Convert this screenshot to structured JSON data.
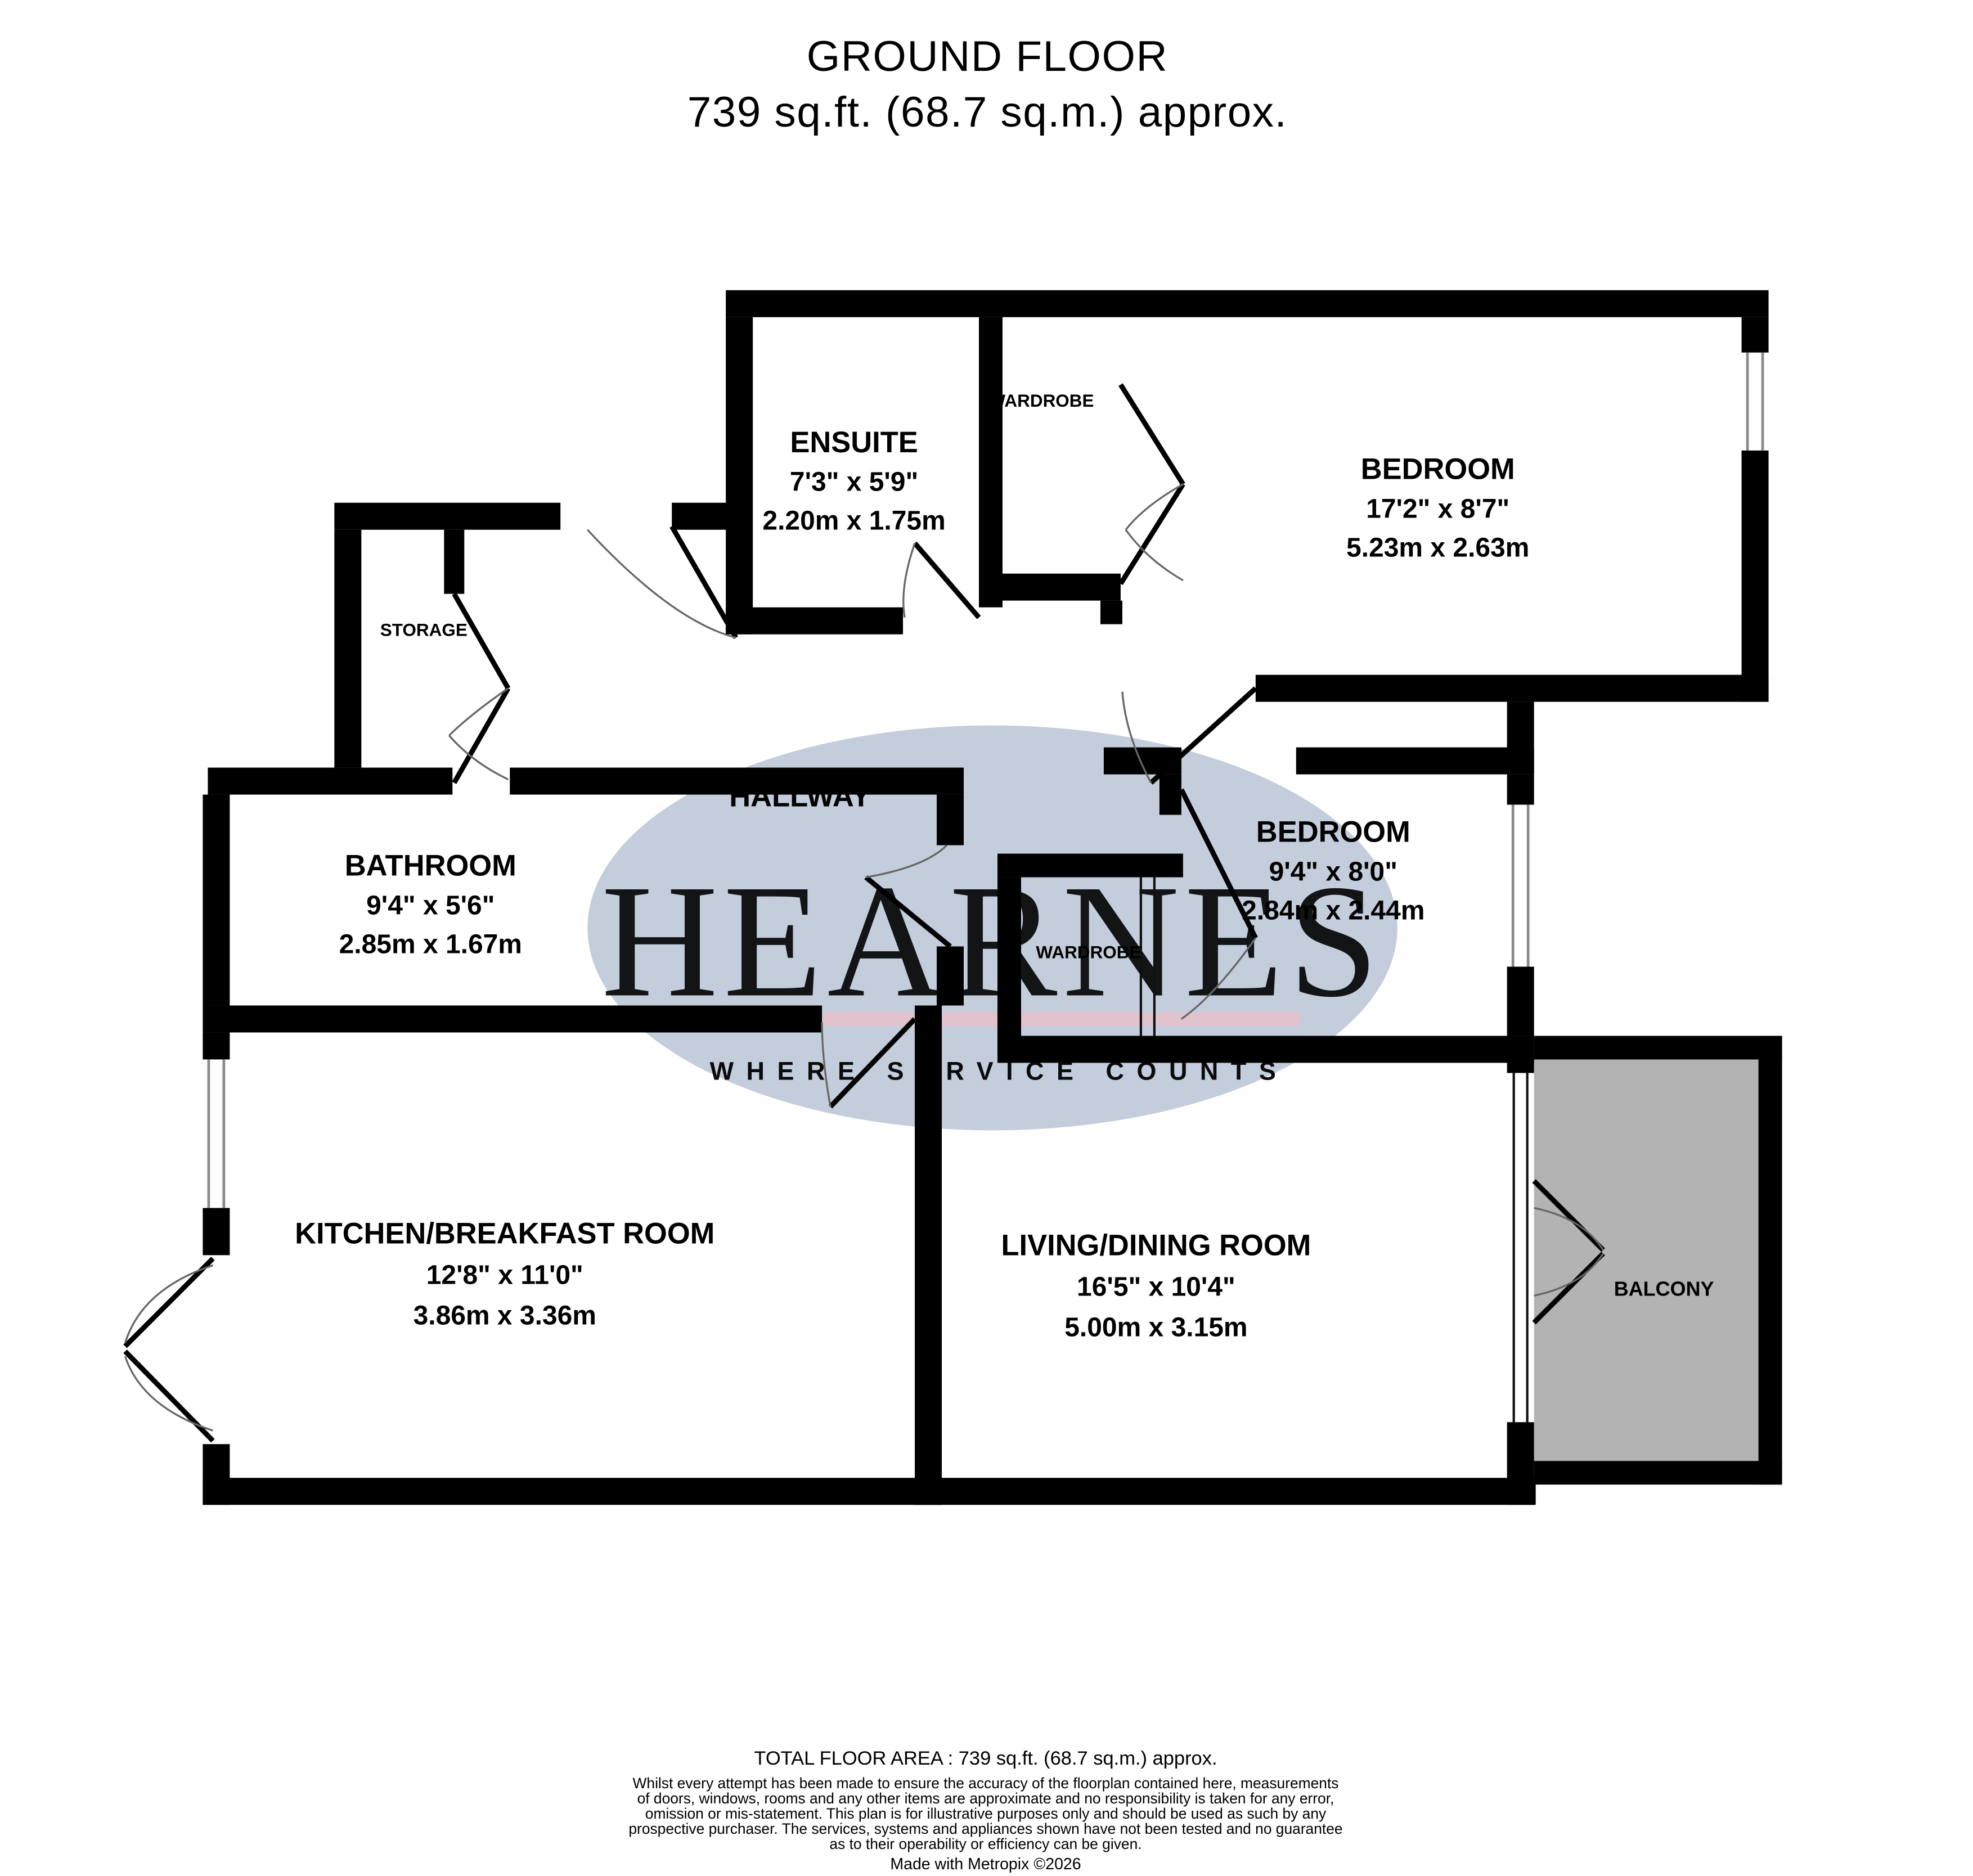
{
  "title": {
    "line1": "GROUND FLOOR",
    "line2": "739 sq.ft. (68.7 sq.m.) approx."
  },
  "watermark": {
    "name": "HEARNES",
    "tagline": "WHERE SERVICE COUNTS",
    "ellipse_color": "#b7c2d3",
    "name_color": "#efe4ab",
    "stripe_color": "#e9bfc7",
    "tagline_color": "#f8f8f8"
  },
  "colors": {
    "wall": "#000000",
    "balcony_fill": "#b3b3b3",
    "floor": "#ffffff"
  },
  "rooms": {
    "ensuite": {
      "name": "ENSUITE",
      "imperial": "7'3\" x 5'9\"",
      "metric": "2.20m x 1.75m"
    },
    "bedroom1": {
      "name": "BEDROOM",
      "imperial": "17'2\" x 8'7\"",
      "metric": "5.23m x 2.63m"
    },
    "bedroom2": {
      "name": "BEDROOM",
      "imperial": "9'4\" x 8'0\"",
      "metric": "2.84m x 2.44m"
    },
    "bathroom": {
      "name": "BATHROOM",
      "imperial": "9'4\" x 5'6\"",
      "metric": "2.85m x 1.67m"
    },
    "kitchen": {
      "name": "KITCHEN/BREAKFAST ROOM",
      "imperial": "12'8\" x 11'0\"",
      "metric": "3.86m x 3.36m"
    },
    "living": {
      "name": "LIVING/DINING ROOM",
      "imperial": "16'5\" x 10'4\"",
      "metric": "5.00m x 3.15m"
    },
    "storage": {
      "name": "STORAGE"
    },
    "hallway": {
      "name": "HALLWAY"
    },
    "balcony": {
      "name": "BALCONY"
    },
    "wardrobe_top": {
      "name": "WARDROBE"
    },
    "wardrobe_middle": {
      "name": "WARDROBE"
    }
  },
  "footer": {
    "total_area": "TOTAL FLOOR AREA : 739 sq.ft. (68.7 sq.m.) approx.",
    "disclaimer_lines": [
      "Whilst every attempt has been made to ensure the accuracy of the floorplan contained here, measurements",
      "of doors, windows, rooms and any other items are approximate and no responsibility is taken for any error,",
      "omission or mis-statement. This plan is for illustrative purposes only and should be used as such by any",
      "prospective purchaser. The services, systems and appliances shown have not been tested and no guarantee",
      "as to their operability or efficiency can be given."
    ],
    "credit": "Made with Metropix ©2026"
  }
}
